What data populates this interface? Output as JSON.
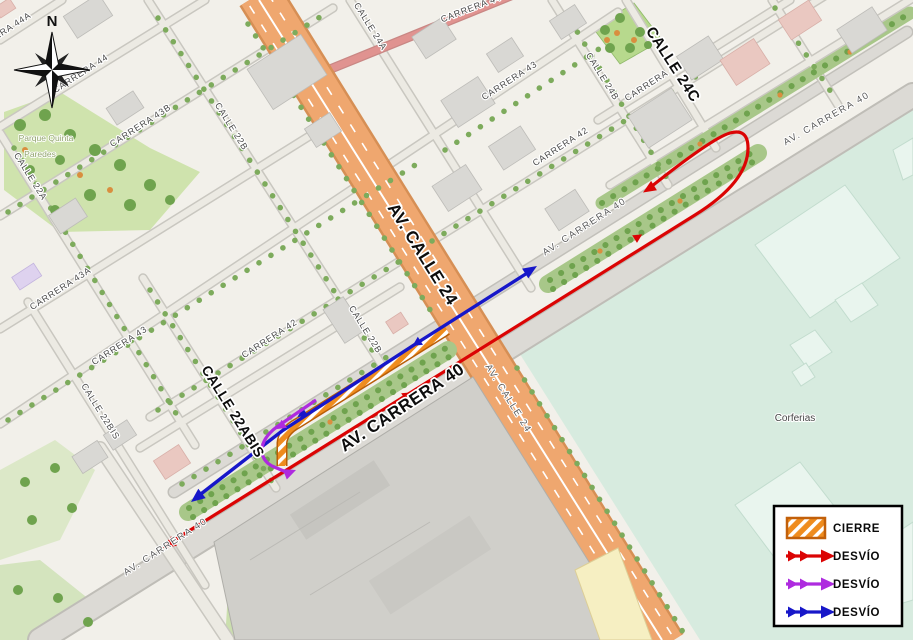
{
  "compass": {
    "north": "N"
  },
  "roads": {
    "av_calle_24_big": "AV. CALLE 24",
    "av_carrera_40_big": "AV. CARRERA 40",
    "calle_24c_big": "CALLE 24C",
    "calle_22abis_big": "CALLE 22ABIS",
    "av_carrera_40_ne": "AV. CARRERA 40",
    "av_carrera_40_mid": "AV. CARRERA 40",
    "av_carrera_40_sw": "AV. CARRERA 40",
    "av_calle_24_small": "AV. CALLE 24",
    "carrera_44a": "CARRERA 44A",
    "carrera_44": "CARRERA 44",
    "carrera_44_top": "CARRERA 44",
    "carrera_43b": "CARRERA 43B",
    "carrera_43a": "CARRERA 43A",
    "carrera_43_sw": "CARRERA 43",
    "carrera_43_ne": "CARRERA 43",
    "carrera_42_sw": "CARRERA 42",
    "carrera_42_mid": "CARRERA 42",
    "carrera_41": "CARRERA 41",
    "calle_22a": "CALLE 22A",
    "calle_22bis": "CALLE 22BIS",
    "calle_22b_nw": "CALLE 22B",
    "calle_22b_mid": "CALLE 22B",
    "calle_24a": "CALLE 24A",
    "calle_24b": "CALLE 24B"
  },
  "places": {
    "park_line1": "Parque Quinta",
    "park_line2": "Paredes",
    "corferias": "Corferias"
  },
  "legend": {
    "items": [
      {
        "label": "CIERRE",
        "type": "closure",
        "color": "#E8821E"
      },
      {
        "label": "DESVÍO",
        "type": "detour",
        "color": "#DB0404"
      },
      {
        "label": "DESVÍO",
        "type": "detour",
        "color": "#AE2BDF"
      },
      {
        "label": "DESVÍO",
        "type": "detour",
        "color": "#1717C9"
      }
    ]
  },
  "colors": {
    "closure_orange": "#E8821E",
    "closure_border": "#B85E08",
    "detour_red": "#DB0404",
    "detour_purple": "#AE2BDF",
    "detour_blue": "#1717C9",
    "road_orange": "#EFA76F",
    "corferias_teal": "#D7EBDF"
  }
}
